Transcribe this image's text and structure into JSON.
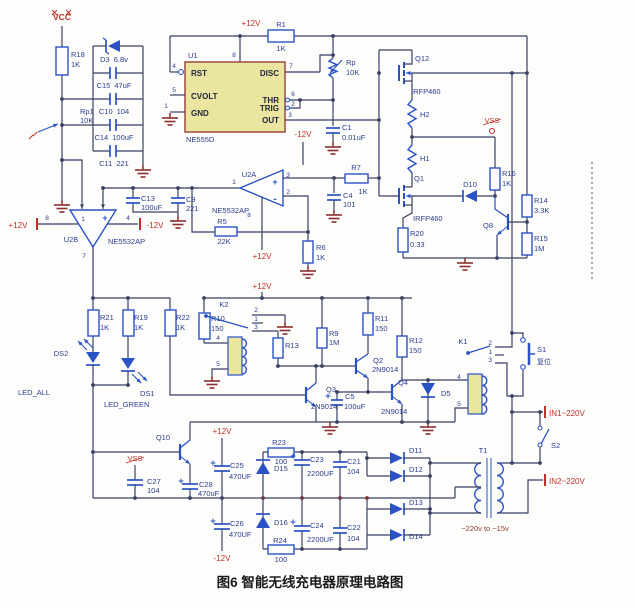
{
  "caption": "图6 智能无线充电器原理电路图",
  "power": {
    "vcc": "VCC",
    "p12": "+12V",
    "n12": "-12V",
    "vss": "VSS"
  },
  "terminals": {
    "in1": "IN1~220V",
    "in2": "IN2~220V"
  },
  "marks": {
    "plus": "+",
    "minus": "-"
  },
  "u1": {
    "ref": "U1",
    "part": "NE555D",
    "pins": {
      "rst": "RST",
      "cvolt": "CVOLT",
      "gnd": "GND",
      "disc": "DISC",
      "thr": "THR",
      "trig": "TRIG",
      "out": "OUT"
    },
    "nums": {
      "rst": "4",
      "cvolt": "5",
      "gnd": "1",
      "vcc": "8",
      "disc": "7",
      "thr": "6",
      "trig": "2",
      "out": "3"
    }
  },
  "u2a": {
    "ref": "U2A",
    "part": "NE5532AP",
    "nums": {
      "out": "1",
      "inp": "3",
      "inn": "2",
      "pwr": "8"
    }
  },
  "u2b": {
    "ref": "U2B",
    "part": "NE5532AP",
    "nums": {
      "inl": "1",
      "vp": "8",
      "vn": "4",
      "out": "7"
    }
  },
  "r": {
    "R18": [
      "R18",
      "1K"
    ],
    "Rp1": [
      "Rp1",
      "10K"
    ],
    "R1": [
      "R1",
      "1K"
    ],
    "Rp": [
      "Rp",
      "10K"
    ],
    "R5": [
      "R5",
      "22K"
    ],
    "R6": [
      "R6",
      "1K"
    ],
    "R7": [
      "R7",
      "1K"
    ],
    "R21": [
      "R21",
      "1K"
    ],
    "R19": [
      "R19",
      "1K"
    ],
    "R22": [
      "R22",
      "1K"
    ],
    "R10": [
      "R10",
      "150"
    ],
    "R13": [
      "R13"
    ],
    "R9": [
      "R9",
      "1M"
    ],
    "R11": [
      "R11",
      "150"
    ],
    "R12": [
      "R12",
      "150"
    ],
    "R16": [
      "R16",
      "1K"
    ],
    "R14": [
      "R14",
      "3.3K"
    ],
    "R15": [
      "R15",
      "1M"
    ],
    "R20": [
      "R20",
      "0.33"
    ],
    "R23": [
      "R23",
      "100"
    ],
    "R24": [
      "R24",
      "100"
    ]
  },
  "c": {
    "C15": [
      "C15",
      "47uF"
    ],
    "C10": [
      "C10",
      "104"
    ],
    "C14": [
      "C14",
      "100uF"
    ],
    "C11": [
      "C11",
      "221"
    ],
    "C1": [
      "C1",
      "0.01uF"
    ],
    "C13": [
      "C13",
      "100uF"
    ],
    "C9": [
      "C9",
      "221"
    ],
    "C4": [
      "C4",
      "101"
    ],
    "C5": [
      "C5",
      "100uF"
    ],
    "C27": [
      "C27",
      "104"
    ],
    "C28": [
      "C28",
      "470uF"
    ],
    "C25": [
      "C25",
      "470UF"
    ],
    "C26": [
      "C26",
      "470UF"
    ],
    "C23": [
      "C23",
      "2200UF"
    ],
    "C21": [
      "C21",
      "104"
    ],
    "C24": [
      "C24",
      "2200UF"
    ],
    "C22": [
      "C22",
      "104"
    ]
  },
  "d": {
    "D3": [
      "D3",
      "6.8v"
    ],
    "D10": [
      "D10"
    ],
    "D5": [
      "D5"
    ],
    "D15": [
      "D15"
    ],
    "D16": [
      "D16"
    ],
    "D11": [
      "D11"
    ],
    "D12": [
      "D12"
    ],
    "D13": [
      "D13"
    ],
    "D14": [
      "D14"
    ]
  },
  "q": {
    "Q12": [
      "Q12",
      "IRFP460"
    ],
    "Q1": [
      "Q1",
      "IRFP460"
    ],
    "Q8": [
      "Q8"
    ],
    "Q2": [
      "Q2",
      "2N9014"
    ],
    "Q3": [
      "Q3",
      "2N9014"
    ],
    "Q4": [
      "Q4",
      "2N9014"
    ],
    "Q10": [
      "Q10"
    ]
  },
  "l": {
    "H2": "H2",
    "H1": "H1"
  },
  "led": {
    "DS2": [
      "DS2",
      "LED_ALL"
    ],
    "DS1": [
      "DS1",
      "LED_GREEN"
    ]
  },
  "k": {
    "K2": {
      "ref": "K2",
      "p": [
        "2",
        "1",
        "3",
        "4",
        "5"
      ]
    },
    "K1": {
      "ref": "K1",
      "p": [
        "2",
        "1",
        "3",
        "4",
        "5"
      ]
    }
  },
  "s": {
    "S1": {
      "ref": "S1",
      "label": "复位"
    },
    "S2": {
      "ref": "S2"
    }
  },
  "t1": {
    "ref": "T1",
    "note": "~220v to ~15v"
  }
}
